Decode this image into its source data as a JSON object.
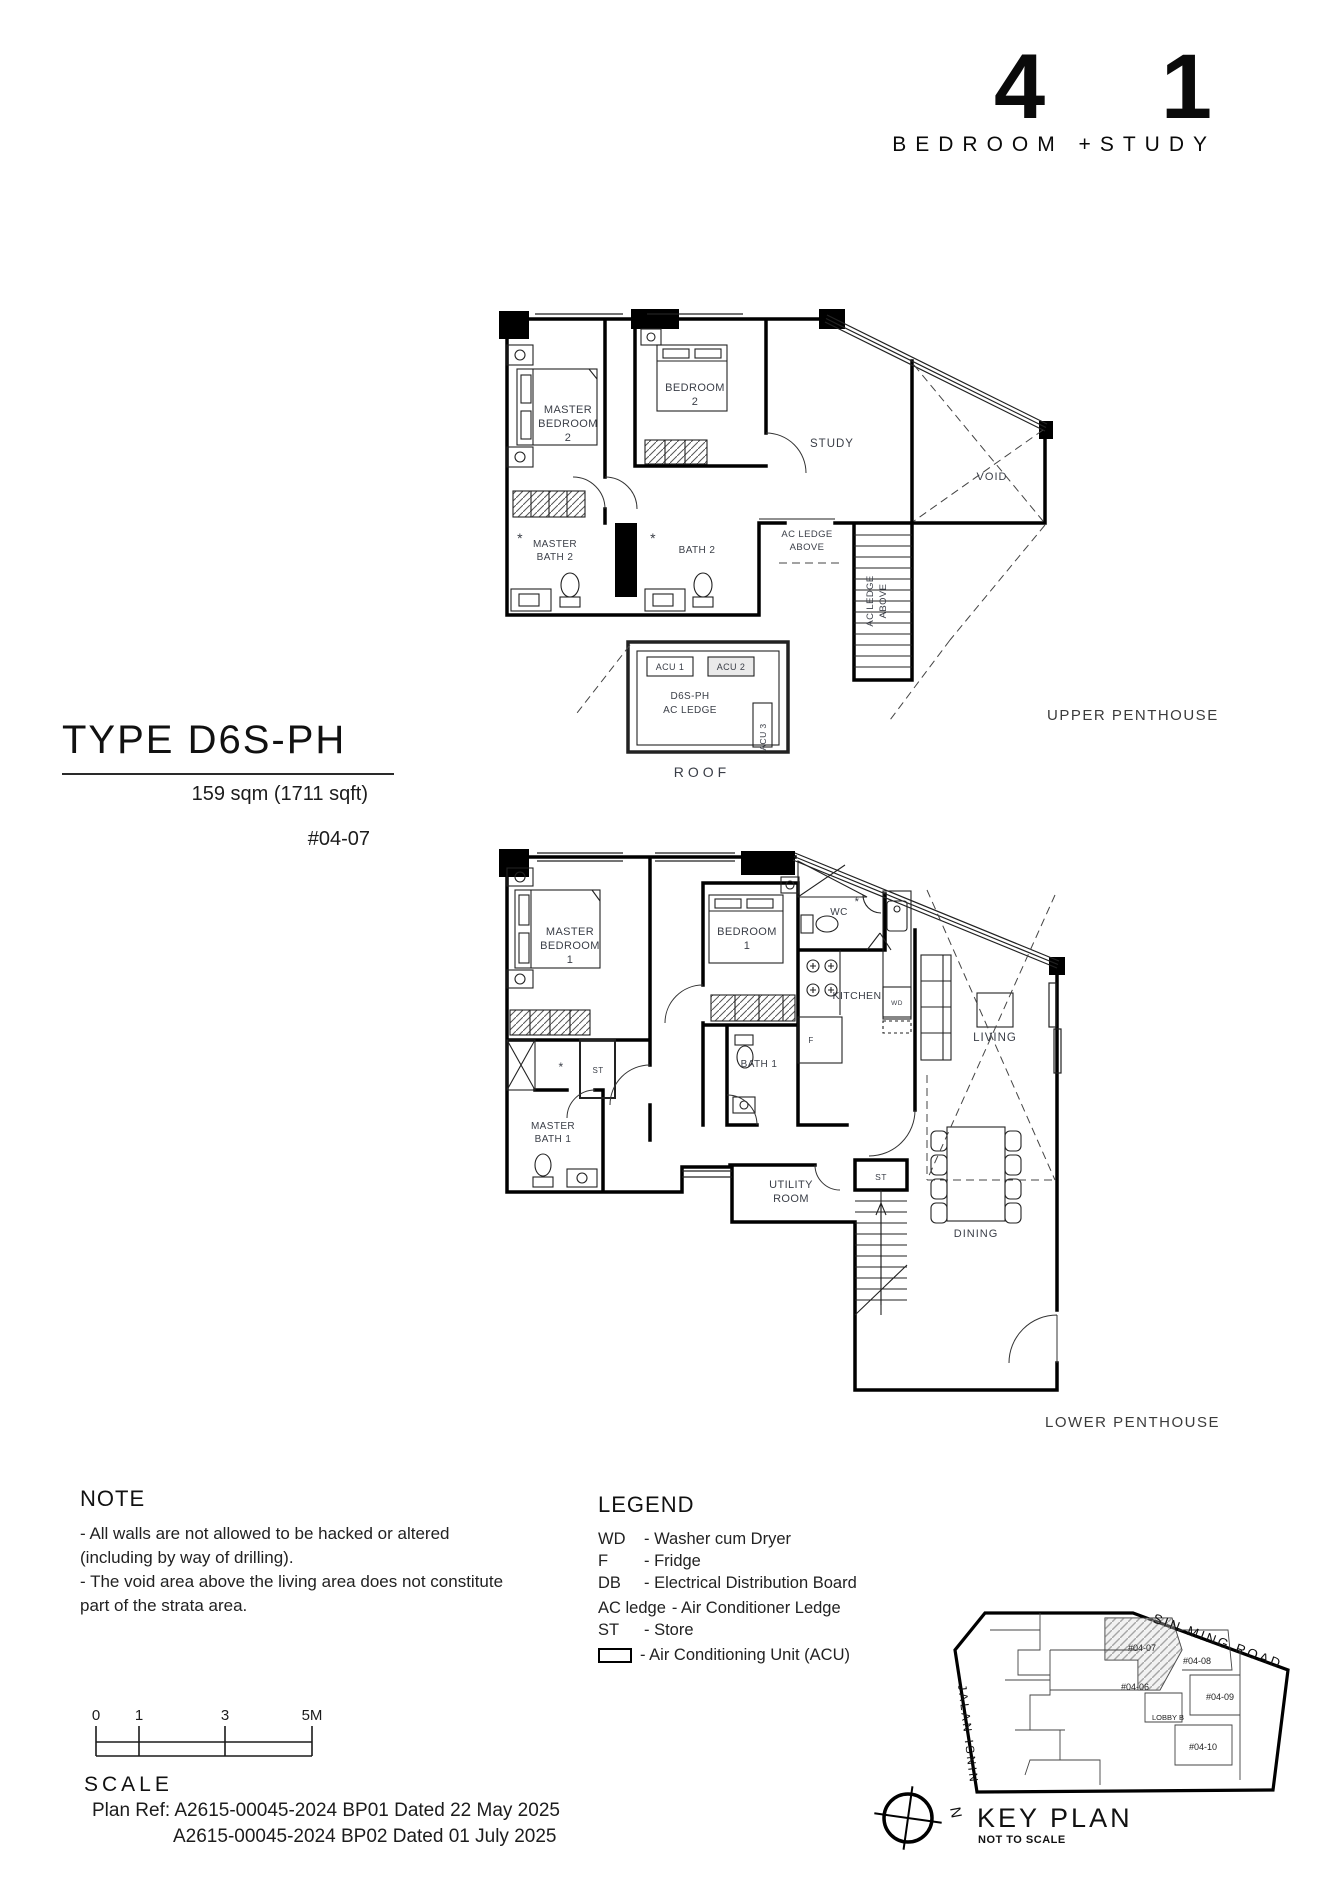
{
  "header": {
    "big_left": "4",
    "big_right": "1",
    "subtitle": "BEDROOM  +STUDY"
  },
  "unit": {
    "type": "TYPE D6S-PH",
    "area": "159 sqm (1711 sqft)",
    "unit_no": "#04-07"
  },
  "upper": {
    "caption": "UPPER PENTHOUSE",
    "labels": {
      "master_bedroom": [
        "MASTER",
        "BEDROOM",
        "2"
      ],
      "bedroom": [
        "BEDROOM",
        "2"
      ],
      "study": "STUDY",
      "void": "VOID",
      "master_bath": [
        "MASTER",
        "BATH 2"
      ],
      "bath": "BATH 2",
      "ac_ledge_above": [
        "AC LEDGE",
        "ABOVE"
      ],
      "ac_ledge_above_rot": [
        "AC LEDGE",
        "ABOVE"
      ],
      "acu1": "ACU 1",
      "acu2": "ACU 2",
      "acu3": "ACU 3",
      "ac_ledge_box": [
        "D6S-PH",
        "AC LEDGE"
      ],
      "roof": "ROOF"
    }
  },
  "lower": {
    "caption": "LOWER PENTHOUSE",
    "labels": {
      "master_bedroom": [
        "MASTER",
        "BEDROOM",
        "1"
      ],
      "bedroom": [
        "BEDROOM",
        "1"
      ],
      "wc": "WC",
      "kitchen": "KITCHEN",
      "fridge": "F",
      "wd": "WD",
      "bath": "BATH 1",
      "st_closet": "ST",
      "master_bath": [
        "MASTER",
        "BATH 1"
      ],
      "utility": [
        "UTILITY",
        "ROOM"
      ],
      "st_store": "ST",
      "living": "LIVING",
      "dining": "DINING"
    }
  },
  "note": {
    "heading": "NOTE",
    "lines": [
      "-  All walls are not allowed to be hacked or altered",
      "(including by way of drilling).",
      "-  The void area above the living area does not constitute",
      "part of the strata area."
    ]
  },
  "legend": {
    "heading": "LEGEND",
    "entries": [
      {
        "abbr": "WD",
        "desc": "-  Washer cum Dryer"
      },
      {
        "abbr": "F",
        "desc": "-  Fridge"
      },
      {
        "abbr": "DB",
        "desc": "-  Electrical Distribution Board"
      },
      {
        "abbr": "AC ledge",
        "desc": "- Air Conditioner Ledge"
      },
      {
        "abbr": "ST",
        "desc": "- Store"
      },
      {
        "abbr": "",
        "desc": "- Air Conditioning Unit (ACU)"
      }
    ]
  },
  "scalebar": {
    "label": "SCALE",
    "ticks": [
      "0",
      "1",
      "3",
      "5M"
    ]
  },
  "plan_ref": {
    "line1": "Plan Ref: A2615-00045-2024 BP01 Dated 22 May 2025",
    "line2": "A2615-00045-2024 BP02 Dated 01 July 2025"
  },
  "keyplan": {
    "title": "KEY PLAN",
    "subtitle": "NOT TO SCALE",
    "north": "N",
    "roads": {
      "sin_ming": "SIN MING ROAD",
      "jalan_isnin": "JALAN ISNIN"
    },
    "units": {
      "u0407": "#04-07",
      "u0408": "#04-08",
      "u0406": "#04-06",
      "u0409": "#04-09",
      "u0410": "#04-10",
      "lobby": "LOBBY B"
    }
  },
  "colors": {
    "walls": "#000000",
    "label_text": "#3a3e47",
    "highlight_fill": "#d9d9d9"
  }
}
